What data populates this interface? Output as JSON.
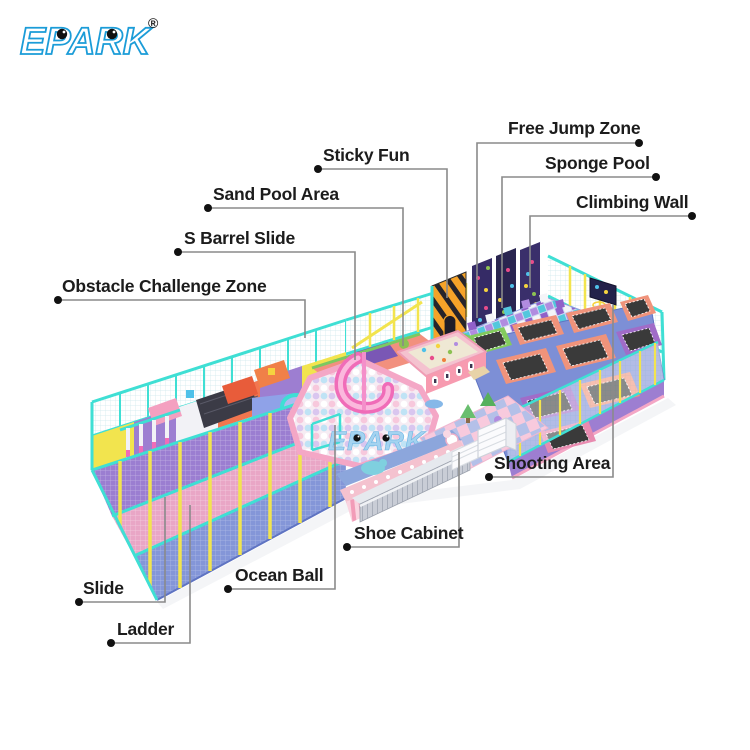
{
  "logo": {
    "text": "EPARK",
    "registered_mark": "®"
  },
  "watermark_text": "EPARK",
  "callouts": [
    {
      "label": "Free Jump Zone"
    },
    {
      "label": "Sponge Pool"
    },
    {
      "label": "Climbing Wall"
    },
    {
      "label": "Sticky Fun"
    },
    {
      "label": "Sand Pool Area"
    },
    {
      "label": "S Barrel Slide"
    },
    {
      "label": "Obstacle Challenge Zone"
    },
    {
      "label": "Shooting Area"
    },
    {
      "label": "Shoe Cabinet"
    },
    {
      "label": "Ocean Ball"
    },
    {
      "label": "Slide"
    },
    {
      "label": "Ladder"
    }
  ],
  "colors": {
    "logo_blue": "#1B9CD8",
    "watermark_blue": "#A4D3F0",
    "frame_cyan": "#3FDFD4",
    "post_yellow": "#F2E44E",
    "slide_magenta": "#F04FC2",
    "ball_pit_rim_pink": "#F4A7C6",
    "sticky_wall_orange": "#F5A329",
    "trampoline_mat": "#3A3A3A",
    "label_text": "#1C1C1C",
    "callout_line": "#8A8A8A",
    "background": "#FFFFFF"
  }
}
